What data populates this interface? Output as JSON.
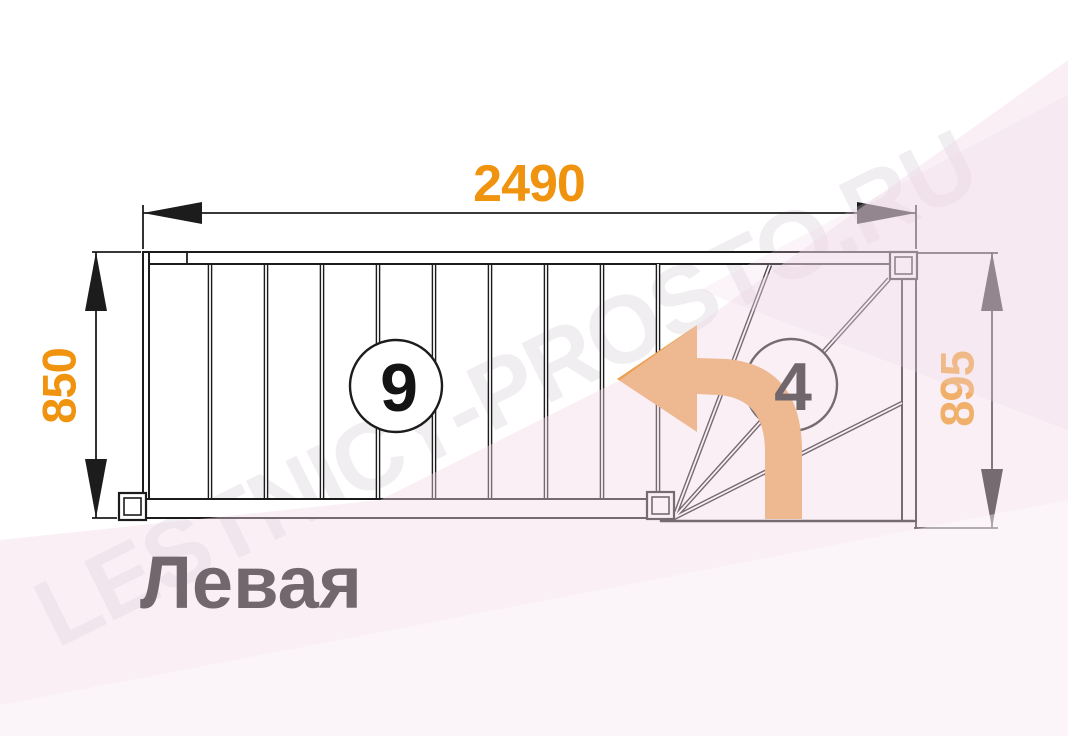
{
  "watermark": "LESTNICY-PROSTO.RU",
  "diagram": {
    "title": "Левая",
    "dimensions": {
      "top_width_mm": "2490",
      "left_height_mm": "850",
      "right_height_mm": "895"
    },
    "step_counts": {
      "straight_flight": "9",
      "winder_turn": "4"
    }
  },
  "icons": {
    "turn_direction": "left-turn-arrow"
  },
  "colors": {
    "dimension_text": "#F0930F",
    "turn_arrow": "#ECA152",
    "drawing_lines": "#1C1C1C",
    "background_tint": "#F7ECF4",
    "watermark_tint": "rgba(95,60,95,0.085)"
  }
}
